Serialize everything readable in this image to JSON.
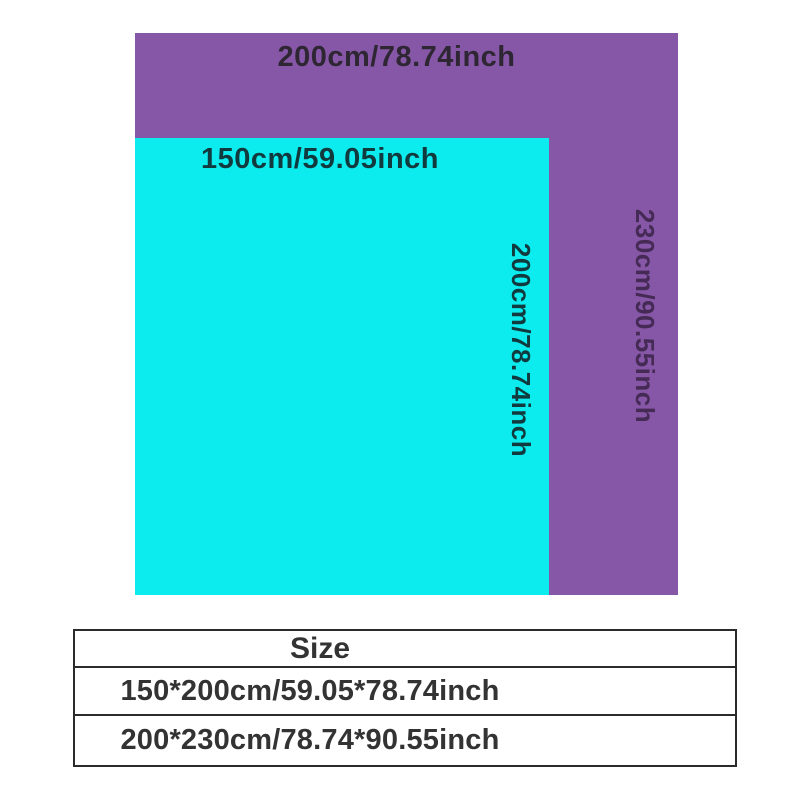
{
  "page": {
    "background": "#ffffff"
  },
  "size_diagram": {
    "large_rect": {
      "width_label": "200cm/78.74inch",
      "height_label": "230cm/90.55inch",
      "fill": "#8657a7"
    },
    "small_rect": {
      "width_label": "150cm/59.05inch",
      "height_label": "200cm/78.74inch",
      "fill": "#0cecef"
    }
  },
  "size_table": {
    "header": "Size",
    "rows": [
      "150*200cm/59.05*78.74inch",
      "200*230cm/78.74*90.55inch"
    ]
  }
}
